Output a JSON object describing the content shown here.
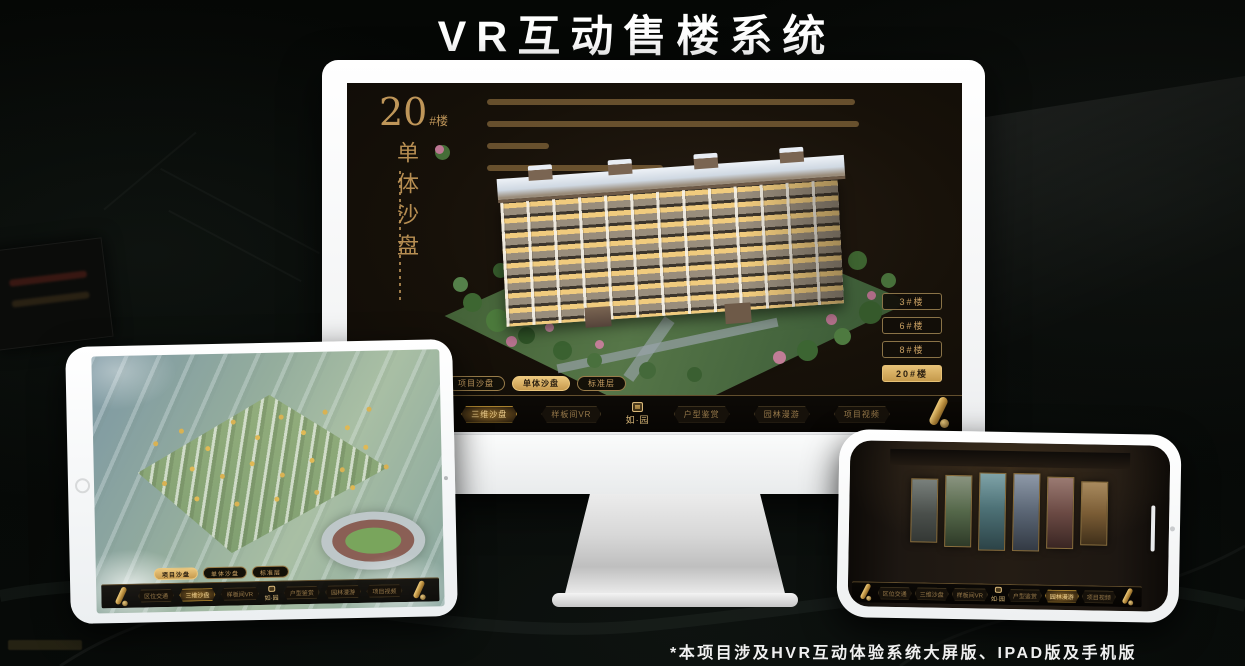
{
  "page": {
    "title": "VR互动售楼系统",
    "footnote": "*本项目涉及HVR互动体验系统大屏版、IPAD版及手机版"
  },
  "app": {
    "heading": {
      "number": "20",
      "unit": "#楼",
      "subtitle": "单体沙盘"
    },
    "tabs": [
      {
        "label": "项目沙盘",
        "active_on_monitor": false,
        "active_on_tablet": true
      },
      {
        "label": "单体沙盘",
        "active_on_monitor": true,
        "active_on_tablet": false
      },
      {
        "label": "标准层",
        "active_on_monitor": false,
        "active_on_tablet": false
      }
    ],
    "floor_buttons": [
      {
        "label": "3#楼",
        "active": false
      },
      {
        "label": "6#楼",
        "active": false
      },
      {
        "label": "8#楼",
        "active": false
      },
      {
        "label": "20#楼",
        "active": true
      }
    ],
    "nav_items": [
      {
        "label": "区位交通"
      },
      {
        "label": "三维沙盘"
      },
      {
        "label": "样板间VR"
      },
      {
        "label": "户型鉴赏"
      },
      {
        "label": "园林漫游"
      },
      {
        "label": "项目视频"
      }
    ],
    "logo": "如·园"
  },
  "phone": {
    "panels": [
      {
        "style": "background:linear-gradient(180deg,#79807c,#4a4f4b 55%,#343835)"
      },
      {
        "style": "background:linear-gradient(180deg,#8a9480,#55684a 50%,#2e3a28)"
      },
      {
        "style": "background:linear-gradient(180deg,#7fa3a8,#4e7277 45%,#2c4347)"
      },
      {
        "style": "background:linear-gradient(180deg,#8e99a8,#5a6574 50%,#333a44)"
      },
      {
        "style": "background:linear-gradient(180deg,#9a7a72,#6b4a44 50%,#3a2623)"
      },
      {
        "style": "background:linear-gradient(180deg,#a88a5e,#7a5c35 50%,#40301a)"
      }
    ]
  },
  "colors": {
    "accent_gold": "#c9a063",
    "active_gold": "#ddb367",
    "screen_bg": "#171109"
  }
}
